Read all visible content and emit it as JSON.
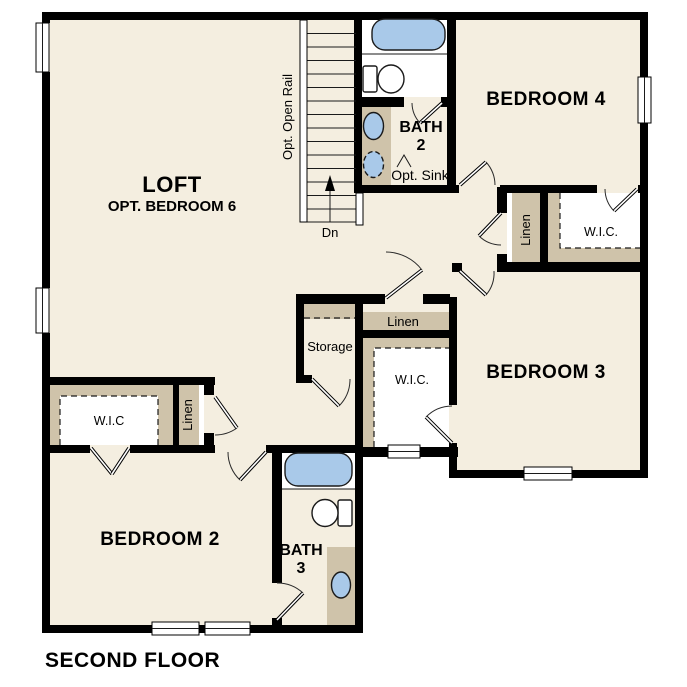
{
  "title": "SECOND FLOOR",
  "colors": {
    "wall": "#000000",
    "floor": "#f4eee0",
    "shelf": "#cfc3aa",
    "fixture": "#a9c9e9",
    "text": "#000000"
  },
  "rooms": {
    "loft": {
      "name": "LOFT",
      "subtitle": "OPT. BEDROOM 6"
    },
    "bedroom2": {
      "name": "BEDROOM 2"
    },
    "bedroom3": {
      "name": "BEDROOM 3"
    },
    "bedroom4": {
      "name": "BEDROOM 4"
    },
    "bath2": {
      "name": "BATH",
      "number": "2",
      "note": "Opt. Sink"
    },
    "bath3": {
      "name": "BATH",
      "number": "3"
    },
    "storage": {
      "name": "Storage"
    },
    "wic_left": {
      "name": "W.I.C"
    },
    "wic_mid": {
      "name": "W.I.C."
    },
    "wic_right": {
      "name": "W.I.C."
    },
    "linen_left": {
      "name": "Linen"
    },
    "linen_mid": {
      "name": "Linen"
    },
    "linen_right": {
      "name": "Linen"
    }
  },
  "stairs": {
    "rail_note": "Opt. Open Rail",
    "down_label": "Dn"
  }
}
